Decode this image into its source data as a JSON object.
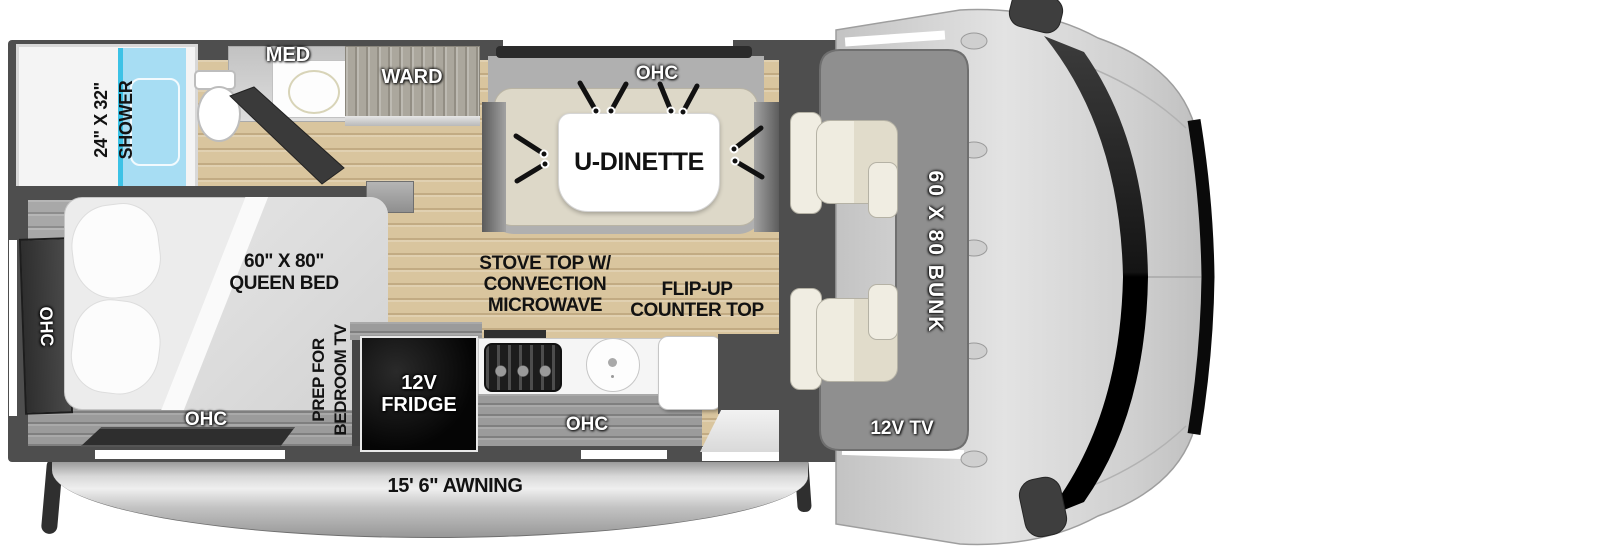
{
  "floorplan": {
    "awning": {
      "label": "15' 6\" AWNING"
    },
    "bathroom": {
      "shower_size": "24\" X 32\"",
      "shower": "SHOWER",
      "med": "MED",
      "ward": "WARD"
    },
    "dinette": {
      "ohc": "OHC",
      "table": "U-DINETTE"
    },
    "bedroom": {
      "bed_size": "60\" X 80\"",
      "bed_type": "QUEEN BED",
      "ohc_rear": "OHC",
      "ohc_foot": "OHC",
      "tv_prep_1": "PREP FOR",
      "tv_prep_2": "BEDROOM TV"
    },
    "kitchen": {
      "stove_1": "STOVE TOP W/",
      "stove_2": "CONVECTION",
      "stove_3": "MICROWAVE",
      "flip_1": "FLIP-UP",
      "flip_2": "COUNTER TOP",
      "fridge_1": "12V",
      "fridge_2": "FRIDGE",
      "ohc": "OHC"
    },
    "cab": {
      "bunk": "60 X 80 BUNK",
      "tv": "12V TV"
    },
    "colors": {
      "wall": "#4e4e4e",
      "floor_wood": "#d9c59e",
      "floor_bedroom": "#a8a8a8",
      "shower_glass": "#aadef2",
      "shower_accent": "#3cc2e6",
      "dinette_cushion": "#ddd8c8",
      "bunk": "#8f8f8f",
      "seat": "#e9e5d7",
      "fridge": "#0b0b0b",
      "cab_body": "#d4d4d4",
      "windshield": "#0c0c0c",
      "awning": "#cccccc"
    }
  }
}
